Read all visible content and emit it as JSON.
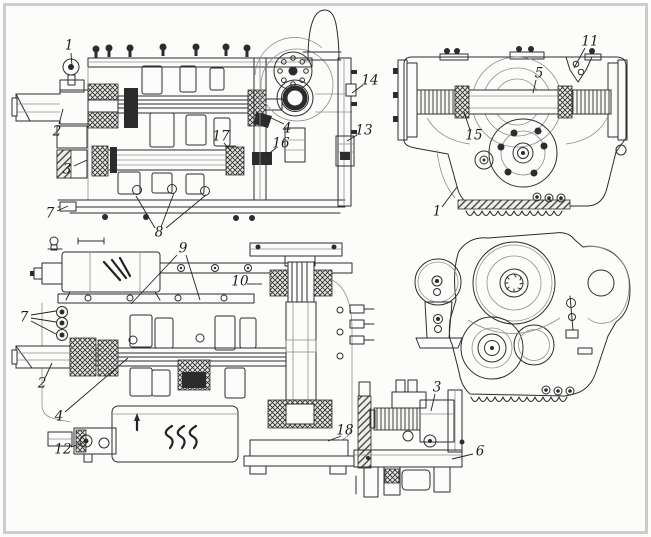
{
  "colors": {
    "paper": "#fcfcfa",
    "frame": "#cdcdcd",
    "ink": "#222222"
  },
  "callouts": [
    {
      "label": "1",
      "x": 69,
      "y": 46,
      "leaders": [
        [
          71,
          53,
          72,
          66
        ]
      ]
    },
    {
      "label": "2",
      "x": 57,
      "y": 132,
      "leaders": [
        [
          59,
          124,
          63,
          109
        ]
      ]
    },
    {
      "label": "3",
      "x": 67,
      "y": 170,
      "leaders": [
        [
          74,
          166,
          87,
          160
        ]
      ]
    },
    {
      "label": "7",
      "x": 50,
      "y": 214,
      "leaders": [
        [
          57,
          211,
          68,
          206
        ]
      ]
    },
    {
      "label": "8",
      "x": 159,
      "y": 233,
      "leaders": [
        [
          155,
          228,
          136,
          196
        ],
        [
          161,
          227,
          174,
          193
        ],
        [
          166,
          228,
          206,
          195
        ]
      ]
    },
    {
      "label": "17",
      "x": 221,
      "y": 137,
      "leaders": [
        [
          224,
          143,
          231,
          151
        ]
      ]
    },
    {
      "label": "16",
      "x": 281,
      "y": 144,
      "leaders": [
        [
          276,
          148,
          266,
          156
        ]
      ]
    },
    {
      "label": "4",
      "x": 287,
      "y": 129,
      "leaders": [
        [
          284,
          124,
          269,
          117
        ]
      ]
    },
    {
      "label": "14",
      "x": 370,
      "y": 81,
      "leaders": [
        [
          363,
          85,
          352,
          93
        ]
      ]
    },
    {
      "label": "13",
      "x": 364,
      "y": 131,
      "leaders": [
        [
          357,
          135,
          347,
          141
        ]
      ]
    },
    {
      "label": "11",
      "x": 590,
      "y": 42,
      "leaders": [
        [
          585,
          48,
          574,
          68
        ]
      ]
    },
    {
      "label": "5",
      "x": 539,
      "y": 74,
      "leaders": [
        [
          536,
          80,
          533,
          93
        ]
      ]
    },
    {
      "label": "15",
      "x": 474,
      "y": 136,
      "leaders": [
        [
          470,
          130,
          464,
          112
        ]
      ]
    },
    {
      "label": "1",
      "x": 437,
      "y": 212,
      "leaders": [
        [
          442,
          207,
          457,
          187
        ]
      ]
    },
    {
      "label": "9",
      "x": 183,
      "y": 249,
      "leaders": [
        [
          177,
          255,
          131,
          304
        ],
        [
          186,
          255,
          200,
          300
        ]
      ]
    },
    {
      "label": "10",
      "x": 240,
      "y": 282,
      "leaders": [
        [
          247,
          284,
          262,
          284
        ]
      ]
    },
    {
      "label": "7",
      "x": 24,
      "y": 318,
      "leaders": [
        [
          31,
          315,
          56,
          311
        ],
        [
          31,
          318,
          56,
          322
        ],
        [
          31,
          321,
          56,
          334
        ]
      ]
    },
    {
      "label": "2",
      "x": 42,
      "y": 384,
      "leaders": [
        [
          45,
          378,
          52,
          363
        ]
      ]
    },
    {
      "label": "4",
      "x": 59,
      "y": 417,
      "leaders": [
        [
          65,
          412,
          128,
          358
        ]
      ]
    },
    {
      "label": "12",
      "x": 63,
      "y": 450,
      "leaders": [
        [
          71,
          447,
          80,
          444
        ]
      ]
    },
    {
      "label": "18",
      "x": 345,
      "y": 431,
      "leaders": [
        [
          341,
          436,
          328,
          441
        ]
      ]
    },
    {
      "label": "3",
      "x": 437,
      "y": 388,
      "leaders": [
        [
          435,
          394,
          431,
          411
        ]
      ]
    },
    {
      "label": "6",
      "x": 480,
      "y": 452,
      "leaders": [
        [
          473,
          454,
          452,
          459
        ]
      ]
    }
  ]
}
